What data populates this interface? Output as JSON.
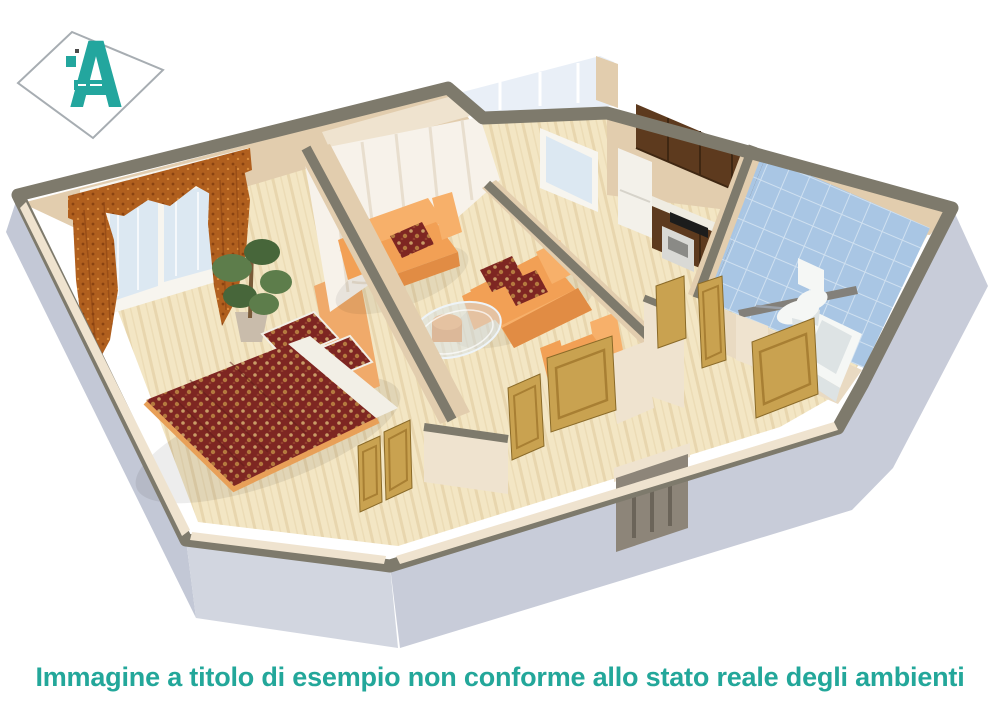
{
  "page": {
    "background": "#ffffff",
    "width": 1000,
    "height": 707
  },
  "logo": {
    "letter": "A",
    "shape": "tilted-diamond-outline-with-teal-letter"
  },
  "caption": {
    "text": "Immagine a titolo di esempio non conforme allo stato reale degli ambienti"
  },
  "floorplan": {
    "type": "3d-apartment-cutaway-render",
    "rooms": [
      {
        "name": "bedroom",
        "contents": [
          "double-bed-floral-duvet",
          "two-floral-pillows",
          "orange-headboard",
          "window-with-drapes-and-valance",
          "potted-plant"
        ]
      },
      {
        "name": "living-room",
        "contents": [
          "orange-sofa",
          "orange-sofa",
          "orange-armchair",
          "glass-coffee-table",
          "orange-ottoman",
          "sheer-curtain-wall"
        ]
      },
      {
        "name": "kitchen",
        "contents": [
          "dark-wood-wall-cabinets",
          "refrigerator",
          "counter",
          "black-cooktop",
          "oven",
          "window"
        ]
      },
      {
        "name": "bathroom",
        "contents": [
          "blue-tiled-walls",
          "toilet",
          "pedestal-sink",
          "bathtub",
          "partition-bar"
        ]
      },
      {
        "name": "hallway",
        "contents": [
          "wooden-swing-doors",
          "entrance-door"
        ]
      },
      {
        "name": "balcony",
        "contents": [
          "glazing-strip"
        ]
      }
    ]
  },
  "colors": {
    "accent_teal": "#23a69e",
    "caption_teal": "#23a79a",
    "diamond_outline": "#a7adb2",
    "wall_top": "#7e7a6c",
    "wall_beige": "#e2cdae",
    "wall_beige_dark": "#d4bd9d",
    "wall_beige_light": "#efe3cf",
    "outer_wall": "#c3c8d6",
    "outer_wall_front": "#d2d6e0",
    "outer_wall_right": "#c8ccd9",
    "floor_wood": "#f3e6c4",
    "floor_stripe": "#e8d6ae",
    "balcony_glass": "#e9eff7",
    "window_glass": "#dce8f2",
    "frame_white": "#f7f5ef",
    "sheer_curtain": "#f7f2ea",
    "sheer_shadow": "#e6dccb",
    "drape_orange": "#b05f1e",
    "drape_dark": "#8a4312",
    "duvet_maroon": "#7e2622",
    "duvet_floral": "#c89b66",
    "mattress_white": "#f2efe6",
    "headboard_orange": "#f0aa6a",
    "bedframe_orange": "#e8a058",
    "sofa_orange": "#f2a055",
    "sofa_light": "#f7b06a",
    "sofa_dark": "#e18c44",
    "glass_table": "#d7e4ee",
    "cabinet_brown": "#5d3a1e",
    "cabinet_dark": "#3f2712",
    "counter_white": "#efece2",
    "fridge_white": "#f3f1ea",
    "cooktop_black": "#1c1c1c",
    "oven_silver": "#d9d9d5",
    "tile_blue": "#a9c6e4",
    "tile_grout": "#cfe0f0",
    "bath_floor": "#e9dac2",
    "partition_bar": "#83807a",
    "fixture_white": "#f5f7f5",
    "fixture_shade": "#dde3e4",
    "door_wood": "#c9a250",
    "door_wood_dark": "#a87f33",
    "entrance_door": "#8d8579",
    "entrance_groove": "#6b6459",
    "plant_green": "#5d7d4b",
    "plant_dark": "#47663a",
    "pot_gray": "#c9bcab",
    "trunk_brown": "#7a5a38"
  }
}
